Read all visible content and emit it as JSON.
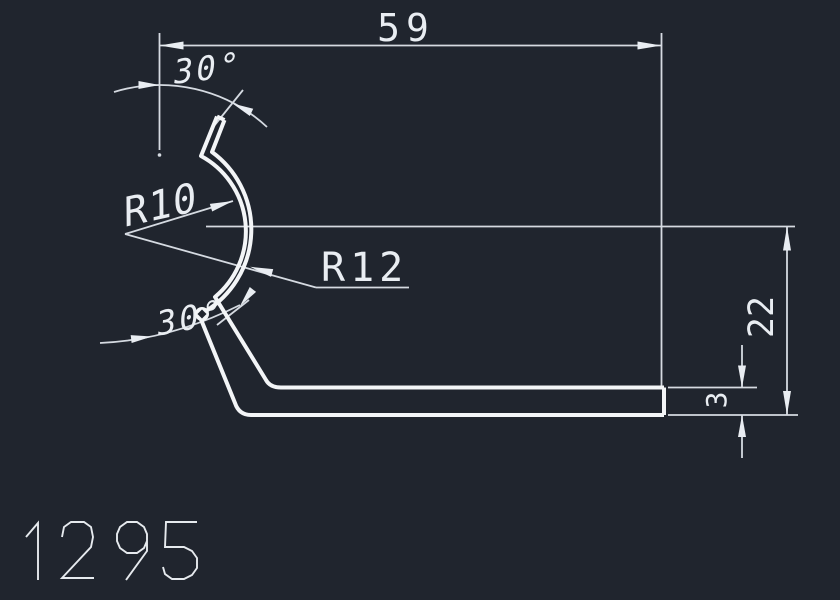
{
  "drawing": {
    "number": "1295",
    "type_label": "profile-cross-section"
  },
  "colors": {
    "background": "#20252e",
    "profile_line": "#f3f5f7",
    "dimension_line": "#d5dae1",
    "text": "#e9edf2"
  },
  "dimensions": {
    "overall_width": {
      "label": "59"
    },
    "overall_height": {
      "label": "22"
    },
    "flange_thickness": {
      "label": "3"
    },
    "radius_inner": {
      "label": "R10"
    },
    "radius_outer": {
      "label": "R12"
    },
    "angle_top": {
      "label": "30°"
    },
    "angle_bottom": {
      "label": "30°"
    }
  }
}
